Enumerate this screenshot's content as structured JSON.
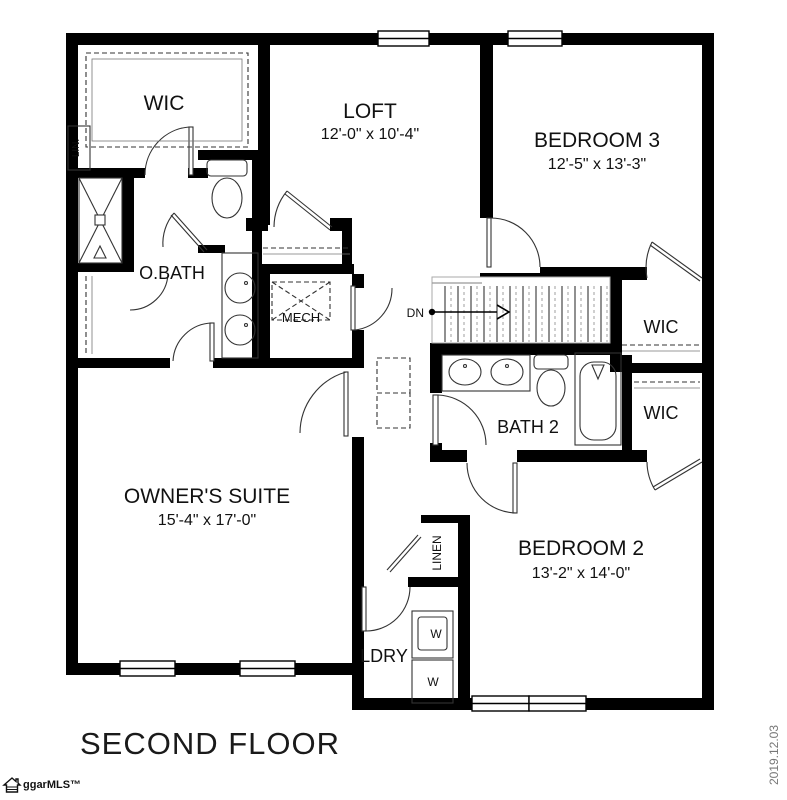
{
  "title": "SECOND FLOOR",
  "footer": {
    "logo_text": "ggarMLS™",
    "date": "2019.12.03"
  },
  "labels": {
    "wic_top": "WIC",
    "lin": "LIN.",
    "loft": {
      "name": "LOFT",
      "dims": "12'-0\" x 10'-4\""
    },
    "bedroom3": {
      "name": "BEDROOM 3",
      "dims": "12'-5\" x 13'-3\""
    },
    "obath": "O.BATH",
    "mech": "MECH",
    "dn": "DN",
    "wic_right_top": "WIC",
    "wic_right_bottom": "WIC",
    "bath2": "BATH 2",
    "owners_suite": {
      "name": "OWNER'S SUITE",
      "dims": "15'-4\" x 17'-0\""
    },
    "linen": "LINEN",
    "bedroom2": {
      "name": "BEDROOM 2",
      "dims": "13'-2\" x 14'-0\""
    },
    "ldry": "LDRY",
    "washer": "W",
    "dryer": "W"
  }
}
